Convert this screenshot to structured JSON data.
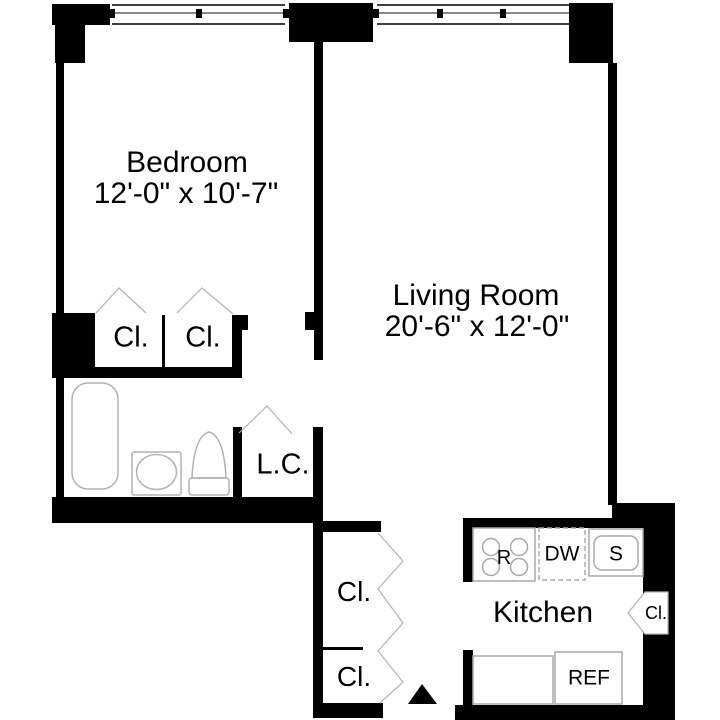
{
  "floorplan": {
    "colors": {
      "wall": "#000000",
      "background": "#ffffff",
      "fixture_outline": "#b2b2b2",
      "text": "#000000"
    },
    "bedroom": {
      "name": "Bedroom",
      "dims": "12'-0\" x 10'-7\""
    },
    "living_room": {
      "name": "Living Room",
      "dims": "20'-6\" x 12'-0\""
    },
    "kitchen": {
      "name": "Kitchen"
    },
    "linen_closet": {
      "label": "L.C."
    },
    "bedroom_closets": {
      "left": "Cl.",
      "right": "Cl."
    },
    "hall_closets": {
      "upper": "Cl.",
      "lower": "Cl."
    },
    "kitchen_closet": {
      "label": "Cl."
    },
    "appliances": {
      "range": "R",
      "dishwasher": "DW",
      "sink": "S",
      "refrigerator": "REF"
    }
  }
}
